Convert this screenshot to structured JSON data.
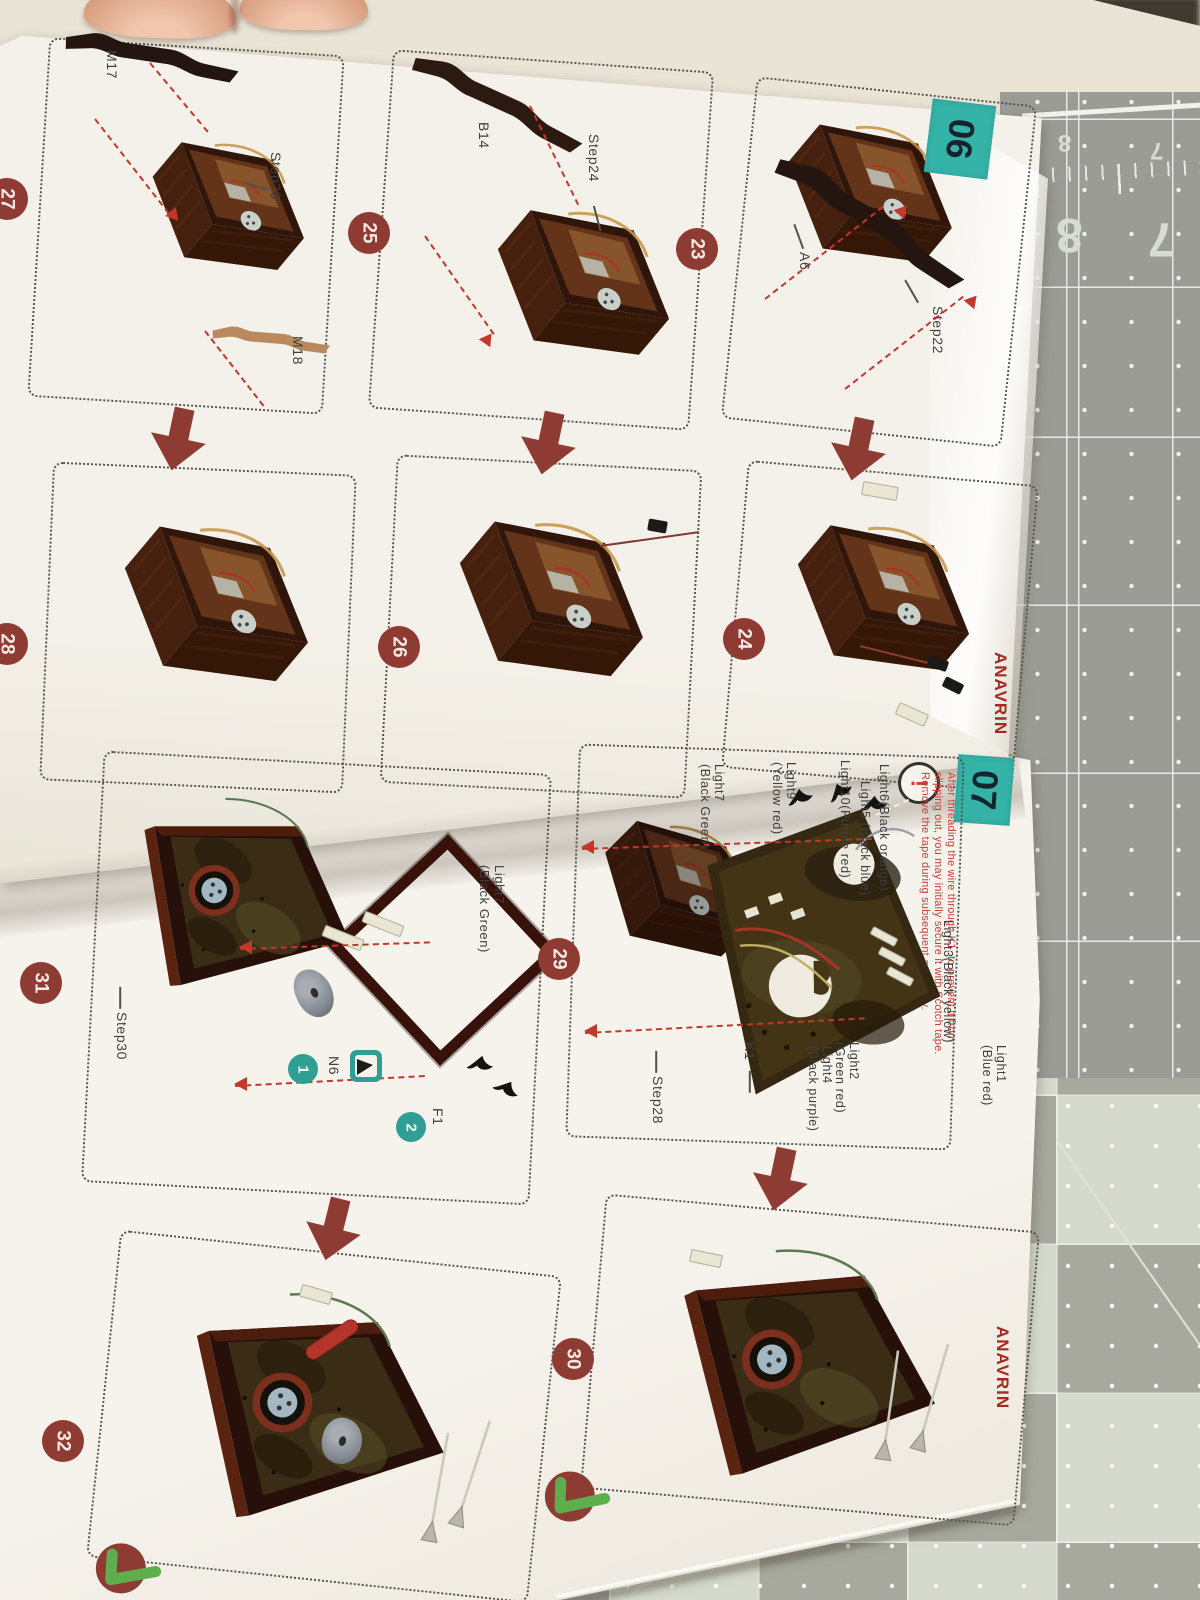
{
  "brand": {
    "logo_text": "ANAVRIN"
  },
  "page06": {
    "badge": "06",
    "labels": {
      "m17": "M17",
      "step26": "Step26",
      "m18": "M18",
      "b14": "B14",
      "step24": "Step24",
      "a6": "A6",
      "step22": "Step22"
    },
    "circles": {
      "c23": "23",
      "c24": "24",
      "c25": "25",
      "c26": "26",
      "c27": "27",
      "c28": "28"
    }
  },
  "page07": {
    "badge": "07",
    "warning_mark": "!",
    "warning_lines": [
      "After threading the wire through K1, to prevent it from",
      "slipping out, you may initially secure it with Scotch tape.",
      "Remove the tape during subsequent assembly."
    ],
    "labels": {
      "light6": "Light6(Black orange)",
      "light5": "Light5 (Black blue)",
      "light10": "Light10(Purple red)",
      "light9": "Light9",
      "light9b": "(Yellow red)",
      "light7": "Light7",
      "light7b": "(Black Green)",
      "light3": "Light3(Black yellow)",
      "light1": "Light1",
      "light1b": "(Blue red)",
      "light2": "Light2",
      "light2b": "(Green red)",
      "light4": "Light4",
      "light4b": "(Black purple)",
      "k1": "K1",
      "step28": "Step28",
      "step30": "Step30",
      "n6": "N6",
      "f1": "F1",
      "tag1": "1",
      "tag2": "2"
    },
    "circles": {
      "c29": "29",
      "c30": "30",
      "c31": "31",
      "c32": "32"
    }
  },
  "mat": {
    "num8": "8",
    "num7": "7"
  },
  "colors": {
    "badge_teal": "#35b3a8",
    "circle_red": "#8e3b33",
    "warning_red": "#c2423a",
    "brand_red": "#a5291f",
    "check_green": "#5fae4e",
    "label_gray": "#3f3f3f",
    "mat_gray": "#9b9c96",
    "mat_light": "#d5dacd",
    "page": "#f3efe8"
  }
}
